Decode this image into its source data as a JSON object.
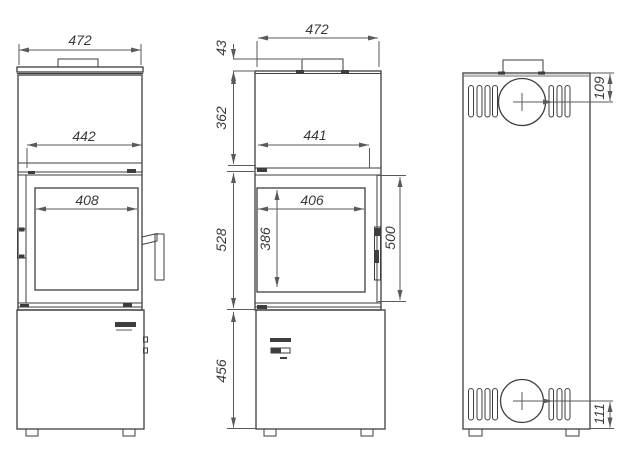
{
  "colors": {
    "line": "#3e3e3e",
    "dim": "#5a5a5a",
    "text": "#3a3a3a",
    "bg": "#ffffff",
    "shade": "#b5b5b5"
  },
  "drawing": {
    "views": {
      "front_a": {
        "dims": {
          "overall_width": "472",
          "door_width": "442",
          "glass_width": "408"
        }
      },
      "front_b": {
        "dims": {
          "overall_width": "472",
          "collar_height": "43",
          "upper_section": "362",
          "opening_width": "441",
          "glass_width": "406",
          "glass_height": "386",
          "door_height": "500",
          "middle_section": "528",
          "base_section": "456"
        }
      },
      "back": {
        "dims": {
          "flue_center_from_top": "109",
          "flue_center_from_bottom": "111"
        }
      }
    }
  }
}
